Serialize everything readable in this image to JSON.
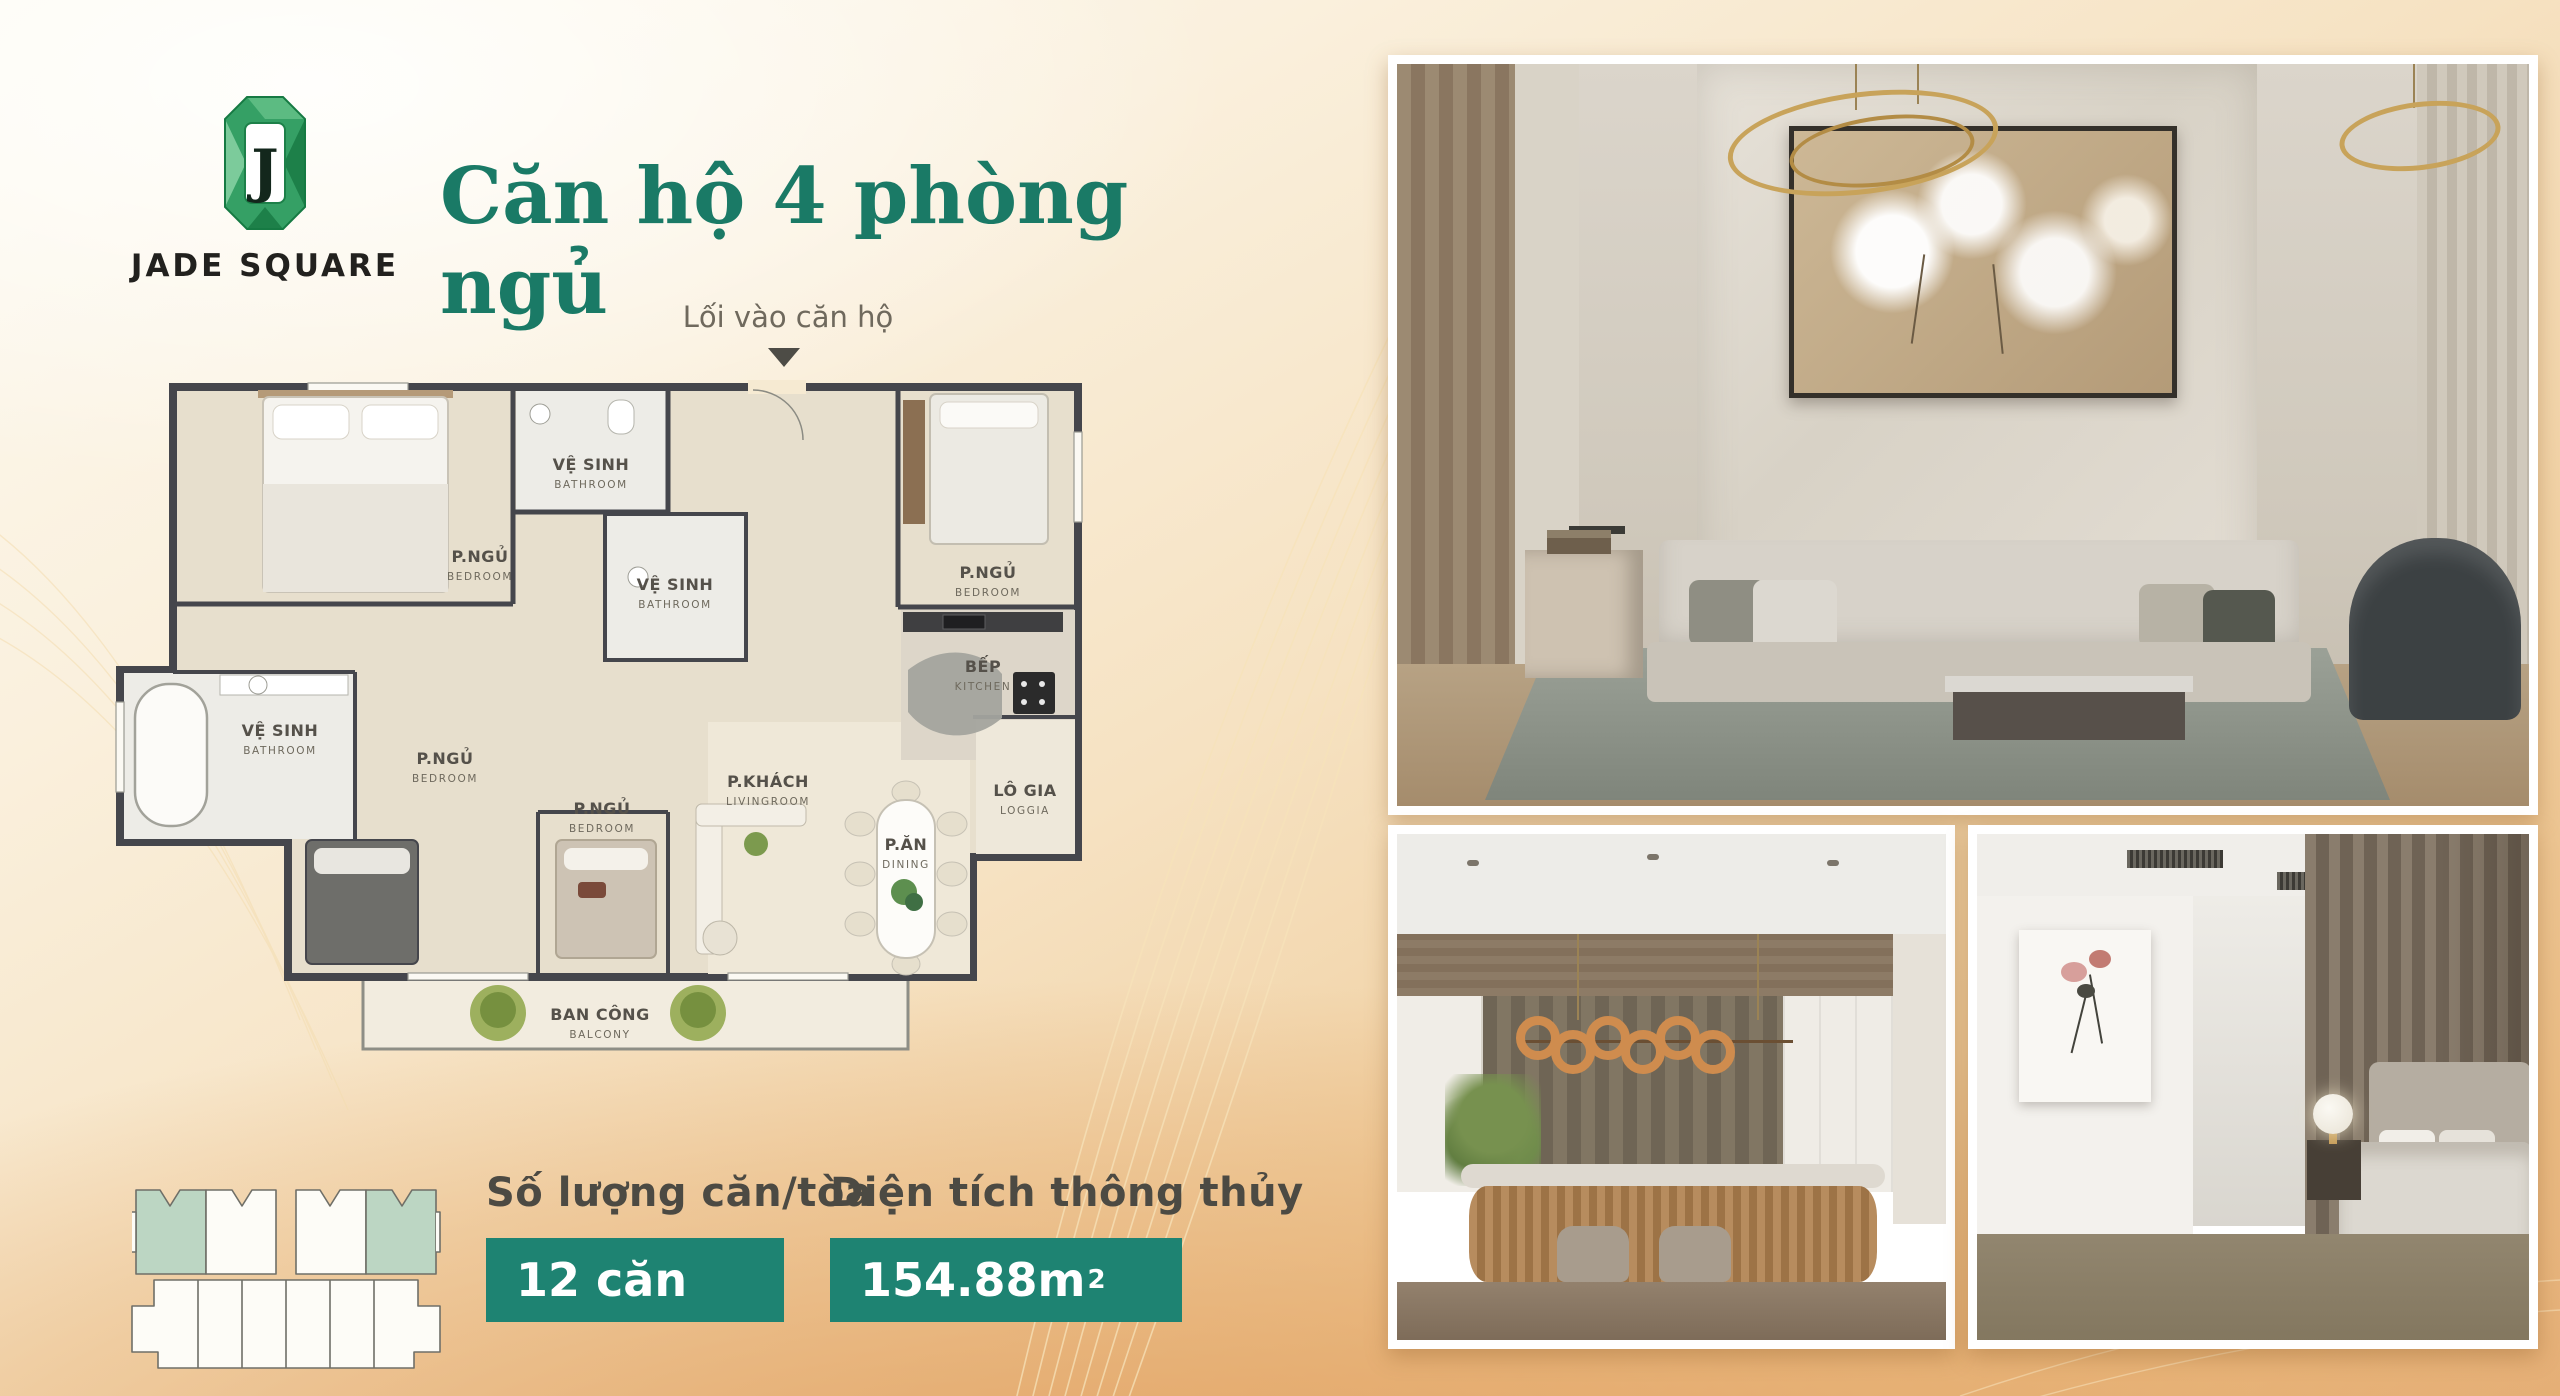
{
  "brand": {
    "monogram": "J",
    "name": "JADE SQUARE"
  },
  "title": "Căn hộ 4 phòng ngủ",
  "entry": {
    "label": "Lối vào căn hộ"
  },
  "floor_plan": {
    "rooms": [
      {
        "vi": "VỆ SINH",
        "en": "BATHROOM"
      },
      {
        "vi": "P.NGỦ",
        "en": "BEDROOM"
      },
      {
        "vi": "VỆ SINH",
        "en": "BATHROOM"
      },
      {
        "vi": "P.NGỦ",
        "en": "BEDROOM"
      },
      {
        "vi": "VỆ SINH",
        "en": "BATHROOM"
      },
      {
        "vi": "BẾP",
        "en": "KITCHEN"
      },
      {
        "vi": "P.NGỦ",
        "en": "BEDROOM"
      },
      {
        "vi": "P.NGỦ",
        "en": "BEDROOM"
      },
      {
        "vi": "P.KHÁCH",
        "en": "LIVINGROOM"
      },
      {
        "vi": "P.ĂN",
        "en": "DINING"
      },
      {
        "vi": "LÔ GIA",
        "en": "LOGGIA"
      },
      {
        "vi": "BAN CÔNG",
        "en": "BALCONY"
      }
    ]
  },
  "key_plan": {
    "highlighted_units": 2
  },
  "stats": {
    "units": {
      "label": "Số lượng căn/tòa",
      "value": "12 căn"
    },
    "area": {
      "label": "Diện tích thông thủy",
      "value": "154.88m",
      "sup": "2"
    }
  },
  "photos": [
    {
      "name": "living-room-photo"
    },
    {
      "name": "kitchen-dining-photo"
    },
    {
      "name": "bedroom-photo"
    }
  ],
  "colors": {
    "title_green": "#1a7a66",
    "badge_teal": "#1e8372",
    "logo_green": "#35a065",
    "unit_highlight": "#bcd6c3",
    "background_orange": "#e9ba82"
  }
}
